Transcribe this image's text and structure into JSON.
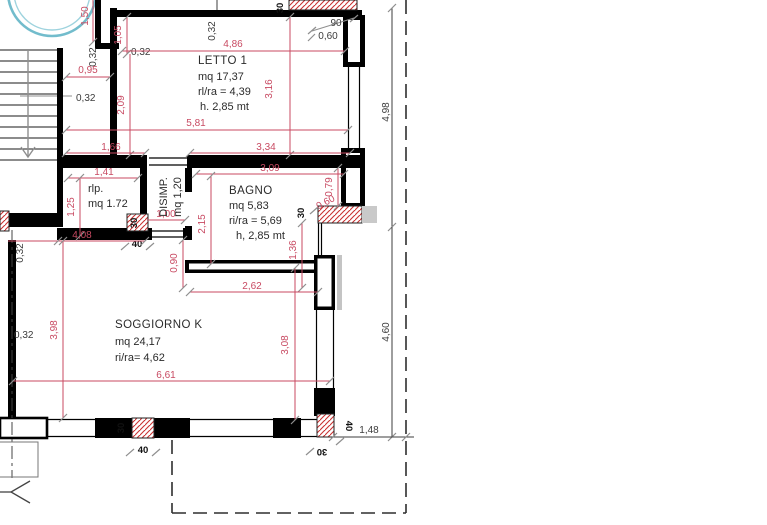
{
  "colors": {
    "wall": "#000000",
    "dimension_red": "#c84a62",
    "hatch_red": "#c93333",
    "circle_stroke": "#72bccc",
    "gray": "#8f8f8f",
    "black_dim": "#3c3c3c"
  },
  "rooms": {
    "letto1": {
      "name": "LETTO 1",
      "area": "mq 17,37",
      "ratio": "rl/ra = 4,39",
      "height": "h. 2,85 mt"
    },
    "rlp": {
      "name": "rlp.",
      "area": "mq 1.72"
    },
    "disimp": {
      "name": "DISIMP.",
      "area": "mq 1,20"
    },
    "bagno": {
      "name": "BAGNO",
      "area": "mq 5,83",
      "ratio": "ri/ra = 5,69",
      "height": "h, 2,85 mt"
    },
    "soggiorno": {
      "name": "SOGGIORNO K",
      "area": "mq 24,17",
      "ratio": "ri/ra= 4,62"
    }
  },
  "dims": {
    "d150": "1,50",
    "d105": "1,05",
    "d486": "4,86",
    "d095": "0,95",
    "d209": "2,09",
    "d316": "3,16",
    "d581": "5,81",
    "d166": "1,66",
    "d334": "3,34",
    "d141": "1,41",
    "d125": "1,25",
    "d309": "3,09",
    "d215": "2,15",
    "d079": "0,79",
    "d060": "0,60",
    "d100": "1,00",
    "d136": "1,36",
    "d408": "4,08",
    "d090": "0,90",
    "d262": "2,62",
    "d398": "3,98",
    "d661": "6,61",
    "d308": "3,08",
    "d498": "4,98",
    "d460": "4,60",
    "d148": "1,48",
    "d90": "90",
    "wall032": "0,32",
    "p30": "30",
    "p40": "40"
  }
}
